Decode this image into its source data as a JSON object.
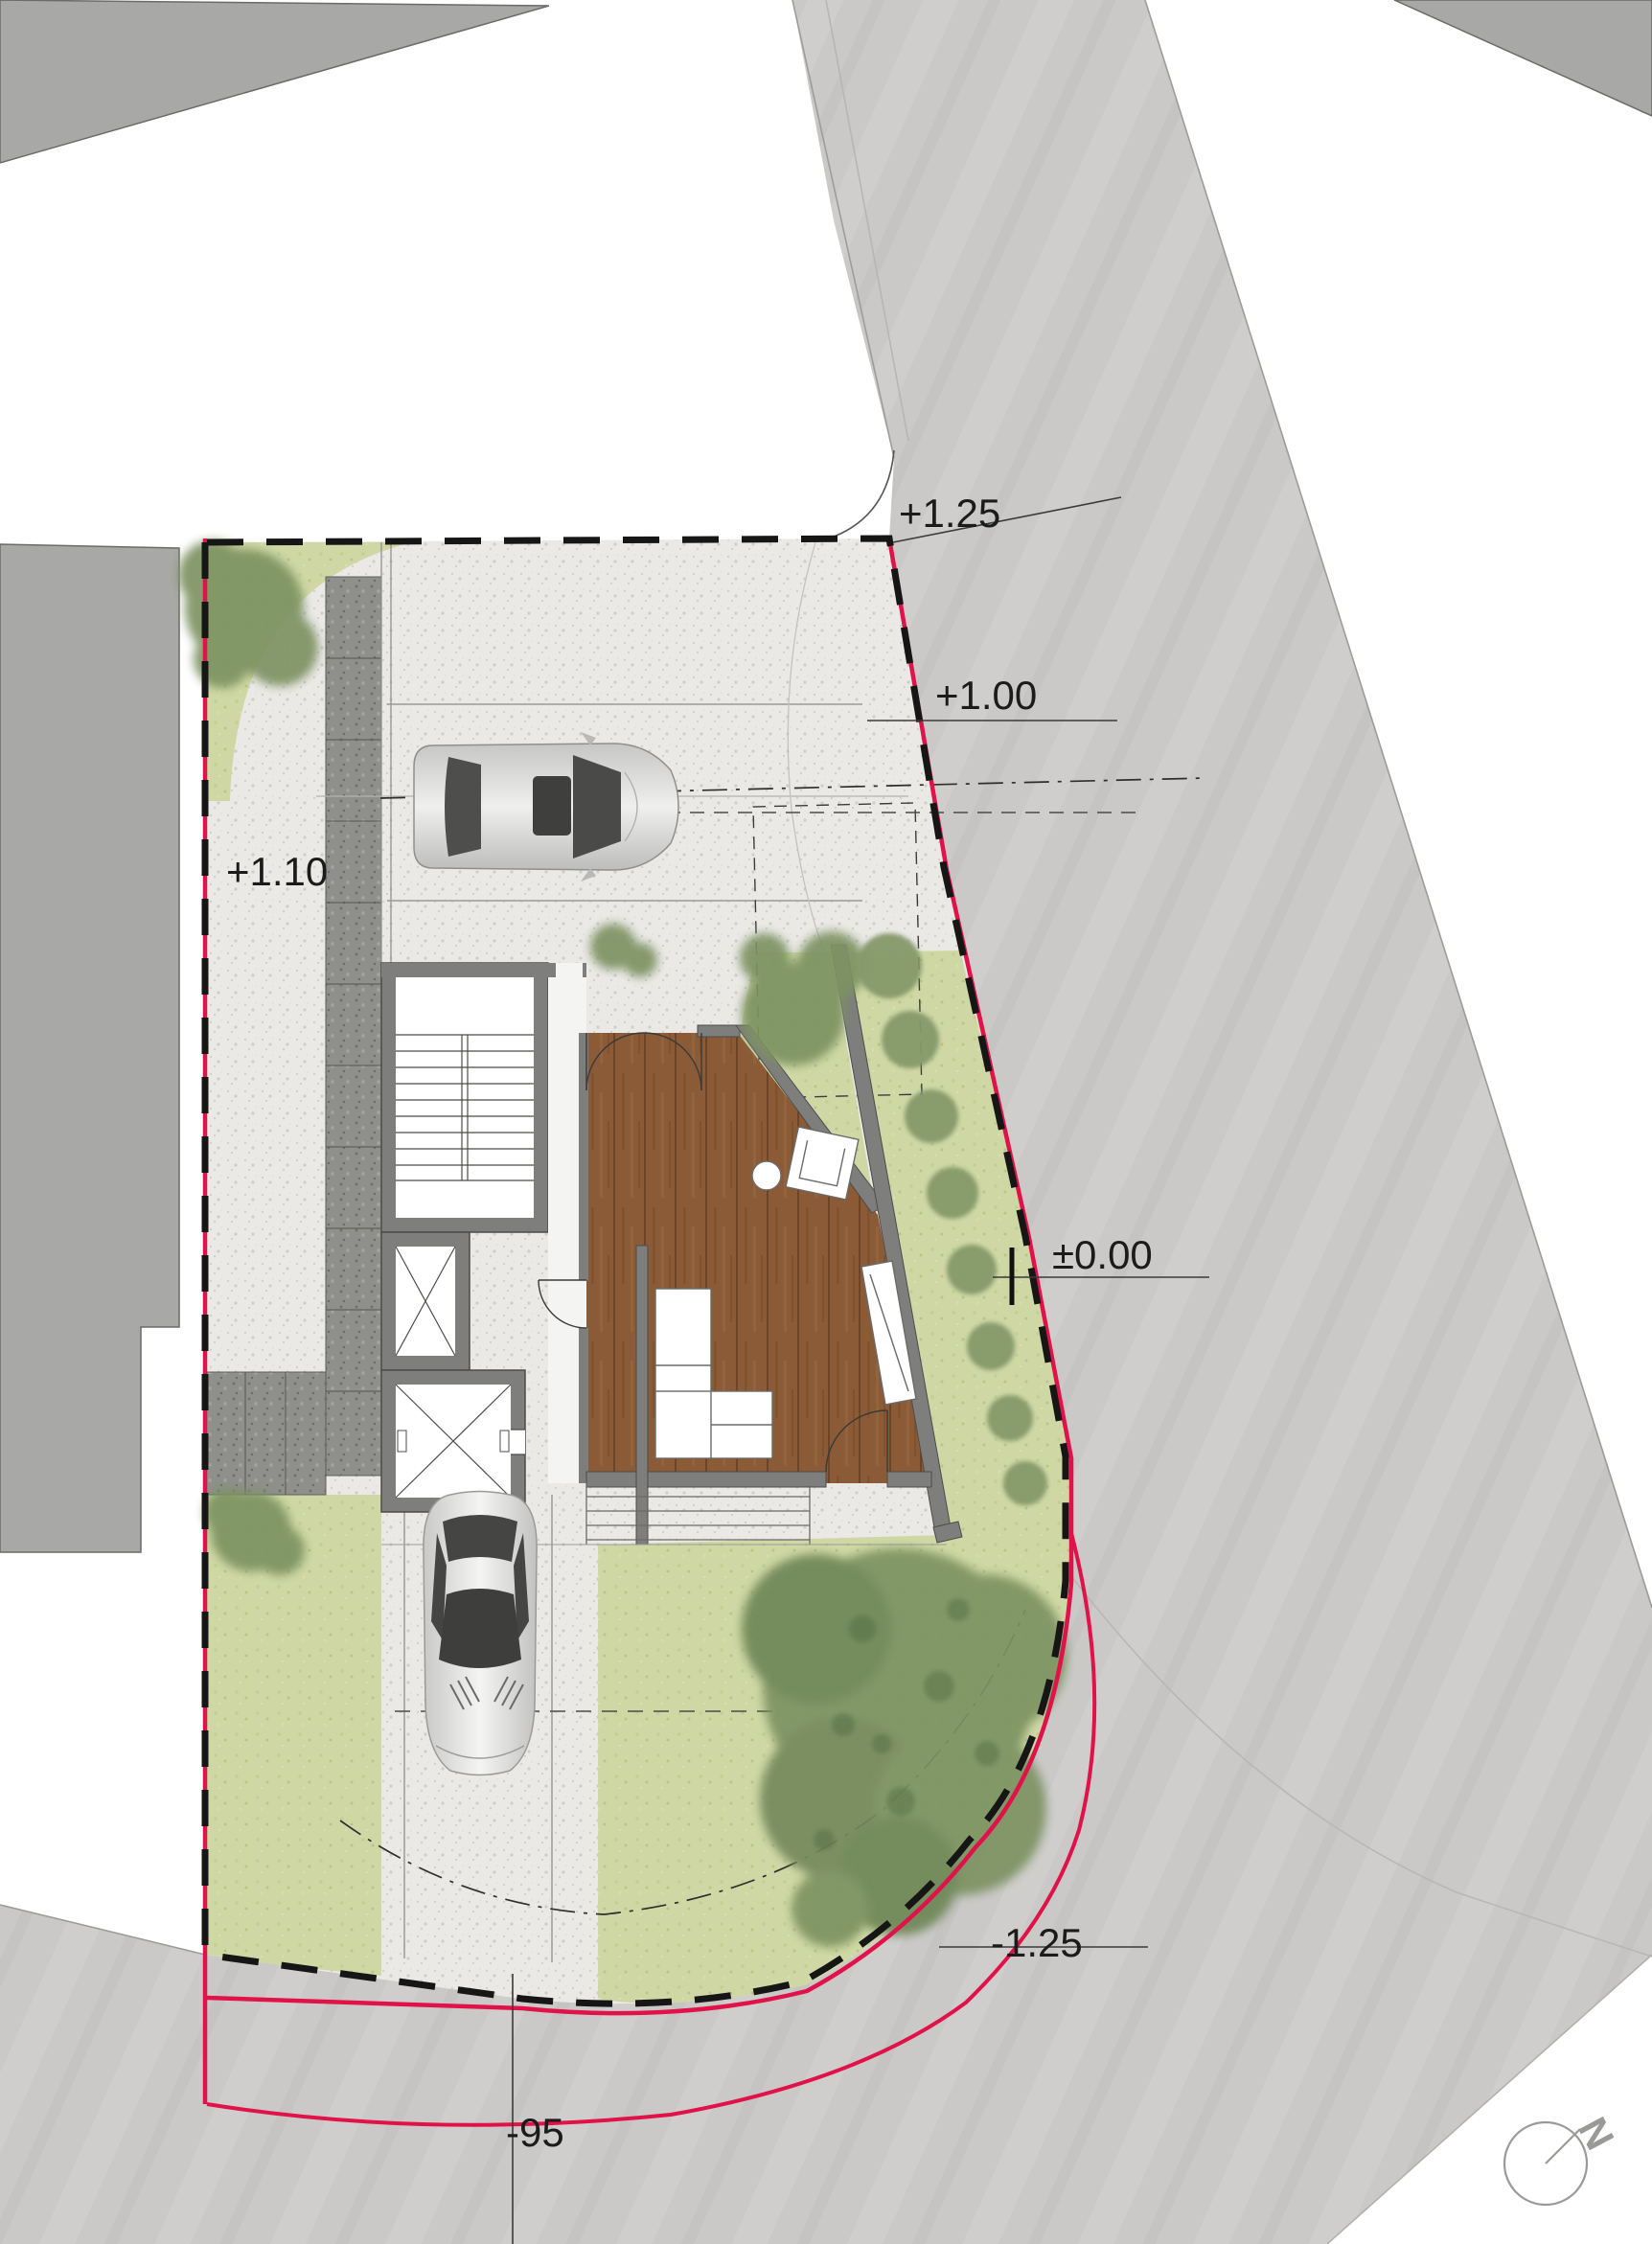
{
  "levels": {
    "street_upper": "+1.25",
    "street_mid": "+1.00",
    "walkway": "+1.10",
    "ground_floor": "±0.00",
    "street_lower": "-1.25",
    "datum": "-95"
  },
  "north": {
    "label": "N"
  },
  "colors": {
    "boundary_red": "#e01249",
    "setback_black": "#161616",
    "road_gray": "#cac9c7",
    "building_gray": "#a8a8a6",
    "site_concrete": "#eae9e6",
    "paving_dark": "#8f8f8c",
    "grass_green": "#cfd8a5",
    "tree_green": "#7d9362",
    "wood_floor": "#8a5b36",
    "wall_gray": "#7e7e7c",
    "car_silver": "#d8d8d6"
  }
}
